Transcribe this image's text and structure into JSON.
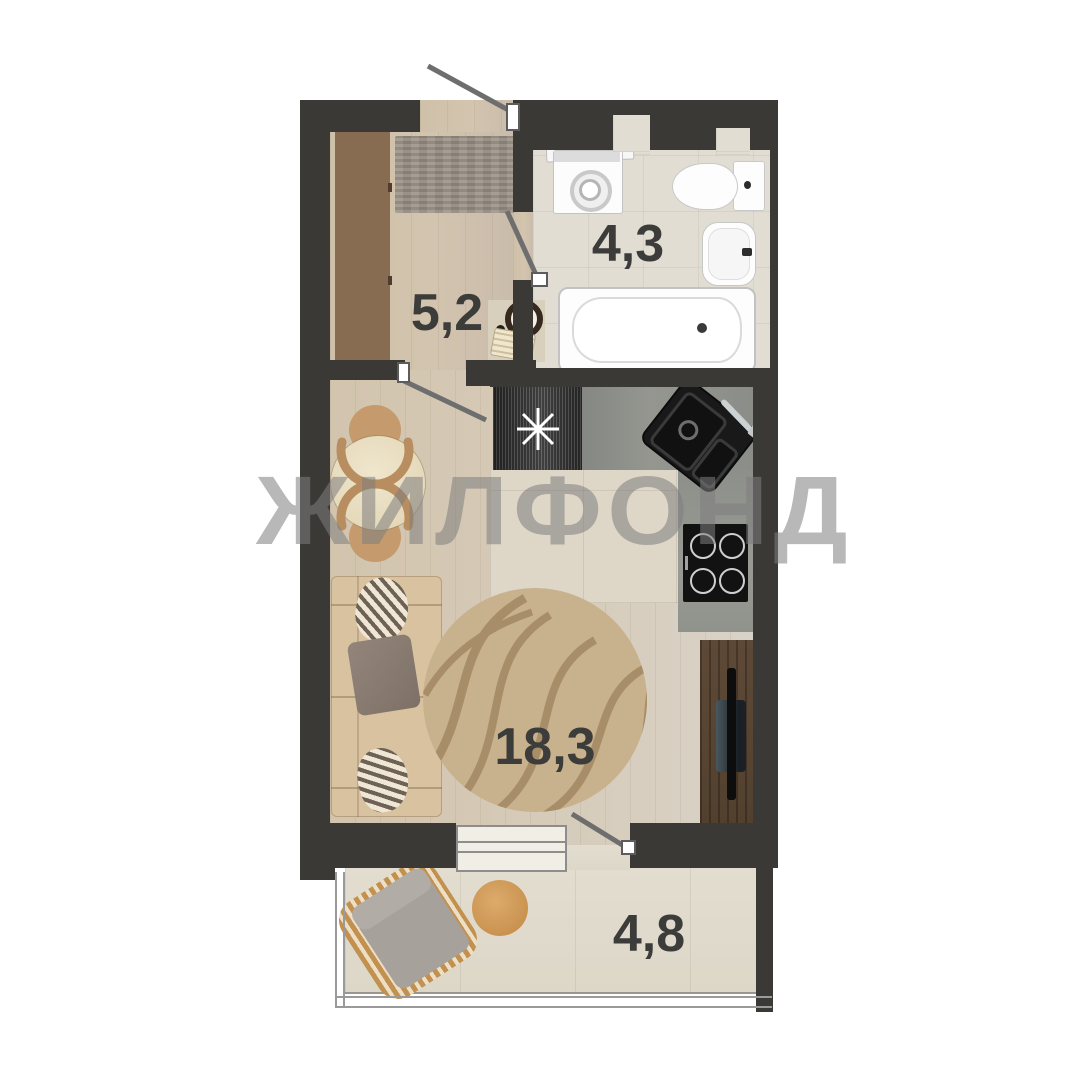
{
  "watermark_text": "ЖИЛФОНД",
  "rooms": {
    "hallway": {
      "name": "hallway",
      "area": "5,2"
    },
    "bathroom": {
      "name": "bathroom",
      "area": "4,3"
    },
    "living": {
      "name": "living-kitchen",
      "area": "18,3"
    },
    "balcony": {
      "name": "balcony",
      "area": "4,8"
    }
  },
  "palette": {
    "wall": "#3b3936",
    "wood_floor": "#d0c2ab",
    "tile_floor": "#e1ddd3",
    "wardrobe_wood": "#8a6f55",
    "counter": "#8f918c",
    "appliance_black": "#161616",
    "sofa": "#d9c29f",
    "rug": "#c8b18d",
    "tv_stand": "#57432f",
    "watermark": "#7f7f7f",
    "label_text": "#3c3c3a"
  }
}
